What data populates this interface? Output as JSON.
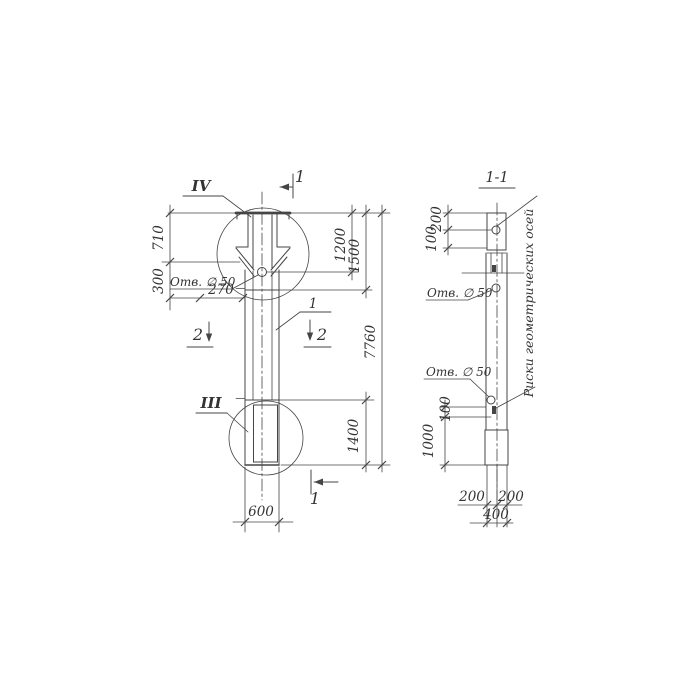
{
  "colors": {
    "background": "#ffffff",
    "ink": "#454545",
    "text": "#333333"
  },
  "front_view": {
    "detail_callout_top": "IV",
    "detail_callout_bottom": "III",
    "section_mark_top": "1",
    "section_mark_bottom": "1",
    "section_mark_left": "2",
    "section_mark_right": "2",
    "position_number": "1",
    "hole_note": "Отв. ∅ 50",
    "dims": {
      "head_top": "710",
      "head_lower": "300",
      "hole_offset": "270",
      "to_hole": "1200",
      "to_joint": "1500",
      "overall": "7760",
      "bottom_segment": "1400",
      "width": "600"
    }
  },
  "section_view": {
    "title": "1-1",
    "hole_note_upper": "Отв. ∅ 50",
    "hole_note_lower": "Отв. ∅ 50",
    "axis_note": "Риски геометрических осей",
    "dims": {
      "head_upper": "200",
      "head_lower": "100",
      "mark_offset": "100",
      "embed_depth": "1000",
      "bottom_left": "200",
      "bottom_right": "200",
      "bottom_total": "400"
    }
  }
}
